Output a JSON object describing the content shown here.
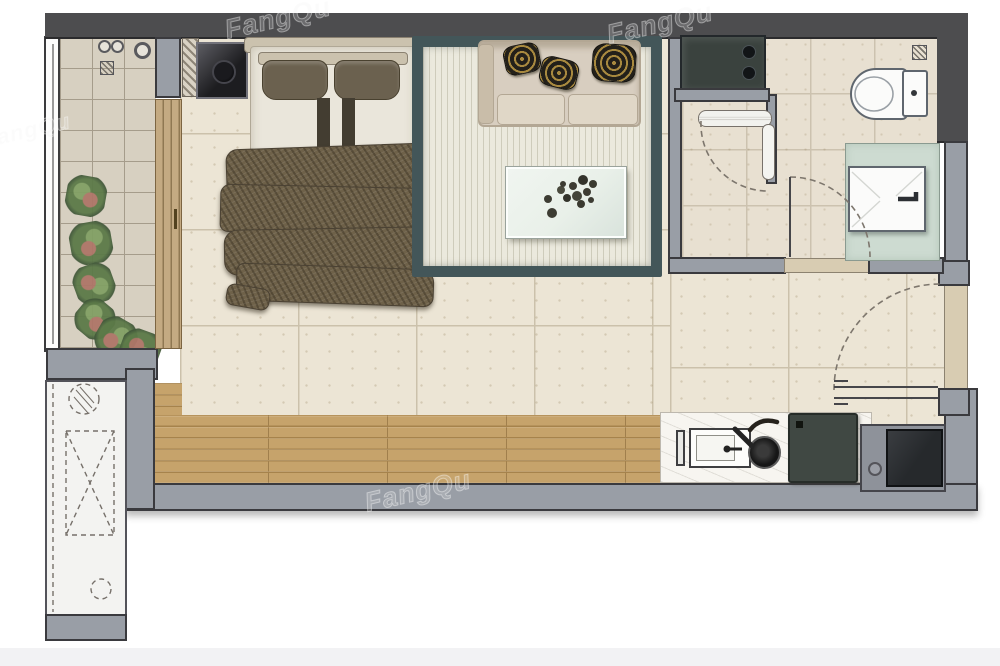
{
  "meta": {
    "scene": "studio-apartment-floor-plan-top-view"
  },
  "watermark": {
    "text": "FangQu"
  },
  "icons": {
    "downpipe-icon": "double-circle",
    "floor-drain-icon": "hatched-square",
    "door-swing-icon": "dashed-quarter-arc",
    "shaft-void-icon": "dashed-rect-with-x",
    "pipe-icon": "hatched-dashed-circle"
  },
  "colors": {
    "pageBg": "#ffffff",
    "pageBottom": "#f2f2f4",
    "wallDark": "#4d4d4f",
    "wallLight": "#999ea6",
    "wallOutline": "#3a3a3e",
    "threshold": "#d8ccb2",
    "balconyTile": "#d7d0c1",
    "balconyGrout": "#a59c8b",
    "mainTile": "#ece5d5",
    "mainGrout": "#cbc1ab",
    "bathTile": "#e8e0d1",
    "bathGrout": "#ccc2af",
    "wood": "#c6a36b",
    "woodLine": "#a6834c",
    "rugBorder": "#435659",
    "rugField": "#ebe9dd",
    "sofaBody": "#d8cec0",
    "sofaLine": "#b3a794",
    "pillowGold": "#a8893f",
    "pillowDark": "#23201a",
    "bedSheet": "#eae6db",
    "headboard": "#cbc2ae",
    "bedPillow": "#6b614f",
    "runnerDark": "#433d31",
    "blanket": "#6e6149",
    "blanketEdge": "#4a4133",
    "nightstand": "#1f1f22",
    "washerBody": "#3a423e",
    "knobDark": "#121517",
    "applianceFrame": "#a4a7ae",
    "counterTop": "#f7f5f0",
    "cooktopDark": "#404843",
    "fridgeFrame": "#8e929a",
    "fridgeInner": "#26292c",
    "vanityTop": "#cddbd1",
    "fixtureWhite": "#fbfbfa",
    "fixtureLine": "#5f666e",
    "sliderWood": "#c4aa82",
    "sliderLine": "#7c6542",
    "shaftFill": "#f3f3f1",
    "dashLine": "#76706a",
    "plantGreen": "#5c7a48",
    "plantRose": "#ae7668",
    "tableTop": "#e9f0e9",
    "decoDark": "#3d3c33",
    "watermarkStroke": "rgba(255,255,255,0.40)"
  }
}
